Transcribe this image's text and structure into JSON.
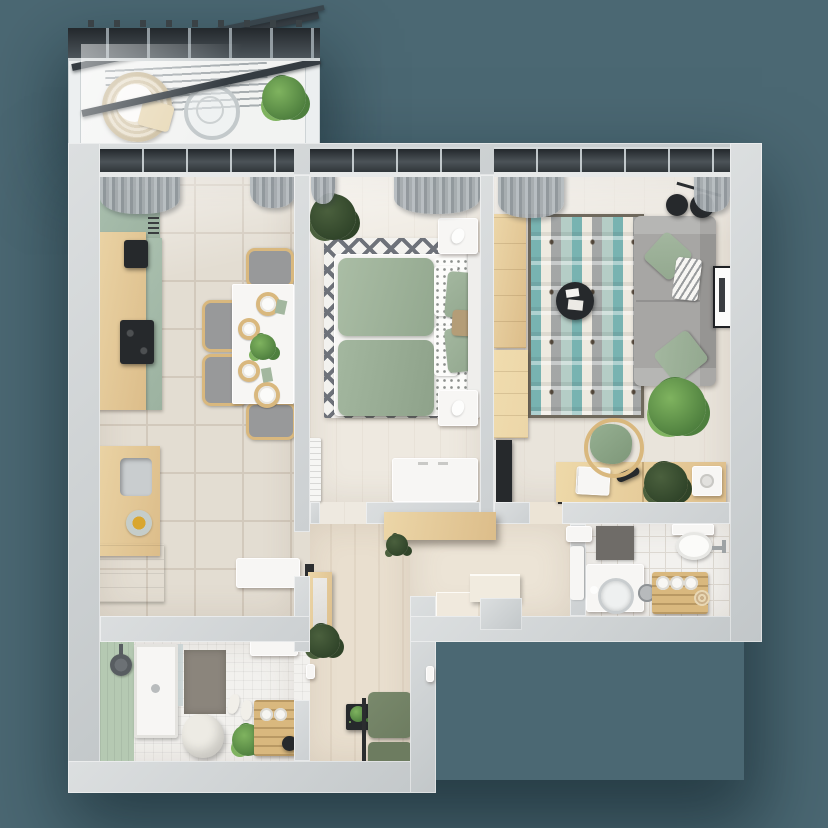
{
  "scene": {
    "kind": "3d-floor-plan-top-view",
    "subject": "two-room apartment with balcony",
    "width_px": 828,
    "height_px": 828
  },
  "palette": {
    "bg": "#4b6873",
    "wallOuter": "#c2c7c9",
    "wallLight": "#dcdfe0",
    "partition": "#ccd0d2",
    "kitchenFloor": "#e3ddd2",
    "grout": "#d2c9bc",
    "bedroomFloor": "#eee9e0",
    "livingFloor": "#e9e4db",
    "hallFloor": "#e9dfcf",
    "vestibuleFloor": "#ece4d6",
    "tileWhite": "#f2f1ee",
    "tileLine": "#ddd9d2",
    "accentGreenWall": "#b5c9b2",
    "cabinetGreen": "#a9bfae",
    "cabinetGreenDark": "#9cb2a0",
    "furnWood": "#dcbd8a",
    "furnWoodLight": "#ecd6a8",
    "sage": "#a3b79f",
    "duvetDark": "#93a88f",
    "white": "#f7f6f4",
    "sofaGray": "#a7a6a4",
    "grayCushion": "#98999a",
    "tealRug": "#5ba5a6",
    "rugGray": "#8b9094",
    "rugCream": "#eeeadd",
    "rugBorder": "#6f695d",
    "diamondGray": "#6e727a",
    "curtain": "#9aa1a6",
    "windowDark": "#23282c",
    "dark": "#26292c",
    "plantDark": "#4e7f3e",
    "plantLight": "#7fb35f",
    "matGray": "#8b857c",
    "tan": "#d9b87e",
    "steel": "#c9cdcf",
    "armchairGreen": "#79896c",
    "armchairGreenDark": "#6d7c60"
  },
  "rooms": [
    {
      "id": "balcony",
      "label": "Balcony",
      "items": [
        "glass-roof",
        "roof-beams",
        "drying-slats",
        "hanging-chair",
        "blanket",
        "round-glass-table",
        "potted-plant"
      ]
    },
    {
      "id": "kitchen-dining",
      "label": "Kitchen / Dining room",
      "items": [
        "green-upper-cabinet",
        "wood-countertop",
        "coffee-machine",
        "cooktop",
        "sink",
        "fruit-bowl",
        "green-base-cabinet",
        "white-bench",
        "dining-table",
        "place-settings",
        "centerpiece-plant",
        "dining-chairs-x4",
        "window-curtains"
      ]
    },
    {
      "id": "bedroom",
      "label": "Bedroom",
      "items": [
        "double-bed",
        "sage-duvet",
        "dotted-pillows",
        "sage-pillows",
        "headboard",
        "nightstand-x2",
        "diamond-rug",
        "potted-plant",
        "radiator",
        "white-dresser",
        "window-curtains"
      ]
    },
    {
      "id": "living-room",
      "label": "Living room",
      "items": [
        "gray-sofa",
        "sage-pillows",
        "zigzag-pillow",
        "geometric-teal-rug",
        "round-coffee-table",
        "floor-lamp-discs",
        "wall-art-frame",
        "monstera-plant",
        "wardrobe",
        "wood-cabinet",
        "tv-panel",
        "desk",
        "laptop",
        "desk-lamp",
        "desk-plant",
        "printer-box",
        "desk-chair",
        "window-curtains"
      ]
    },
    {
      "id": "hallway",
      "label": "Hallway",
      "items": [
        "hanging-console-shelf",
        "console-plant",
        "leaning-mirror",
        "floor-plant",
        "wall-hook",
        "green-armchair",
        "black-side-table",
        "door-handle"
      ]
    },
    {
      "id": "entry",
      "label": "Entry vestibule",
      "items": [
        "entry-step",
        "entry-door",
        "landing",
        "bathroom-door",
        "wall-cabinet"
      ]
    },
    {
      "id": "bathroom",
      "label": "Bathroom",
      "items": [
        "toilet",
        "wall-faucet",
        "dark-wall-panel",
        "vanity-unit",
        "round-basin",
        "metal-bucket",
        "towel-ladder",
        "rolled-towels"
      ]
    },
    {
      "id": "shower-room",
      "label": "Shower room",
      "items": [
        "green-accent-wall",
        "shower-tray",
        "glass-screen",
        "shower-head",
        "gray-mat",
        "slippers",
        "laundry-bag",
        "potted-plant",
        "wooden-crate",
        "towel-rolls",
        "white-shelf"
      ]
    }
  ]
}
